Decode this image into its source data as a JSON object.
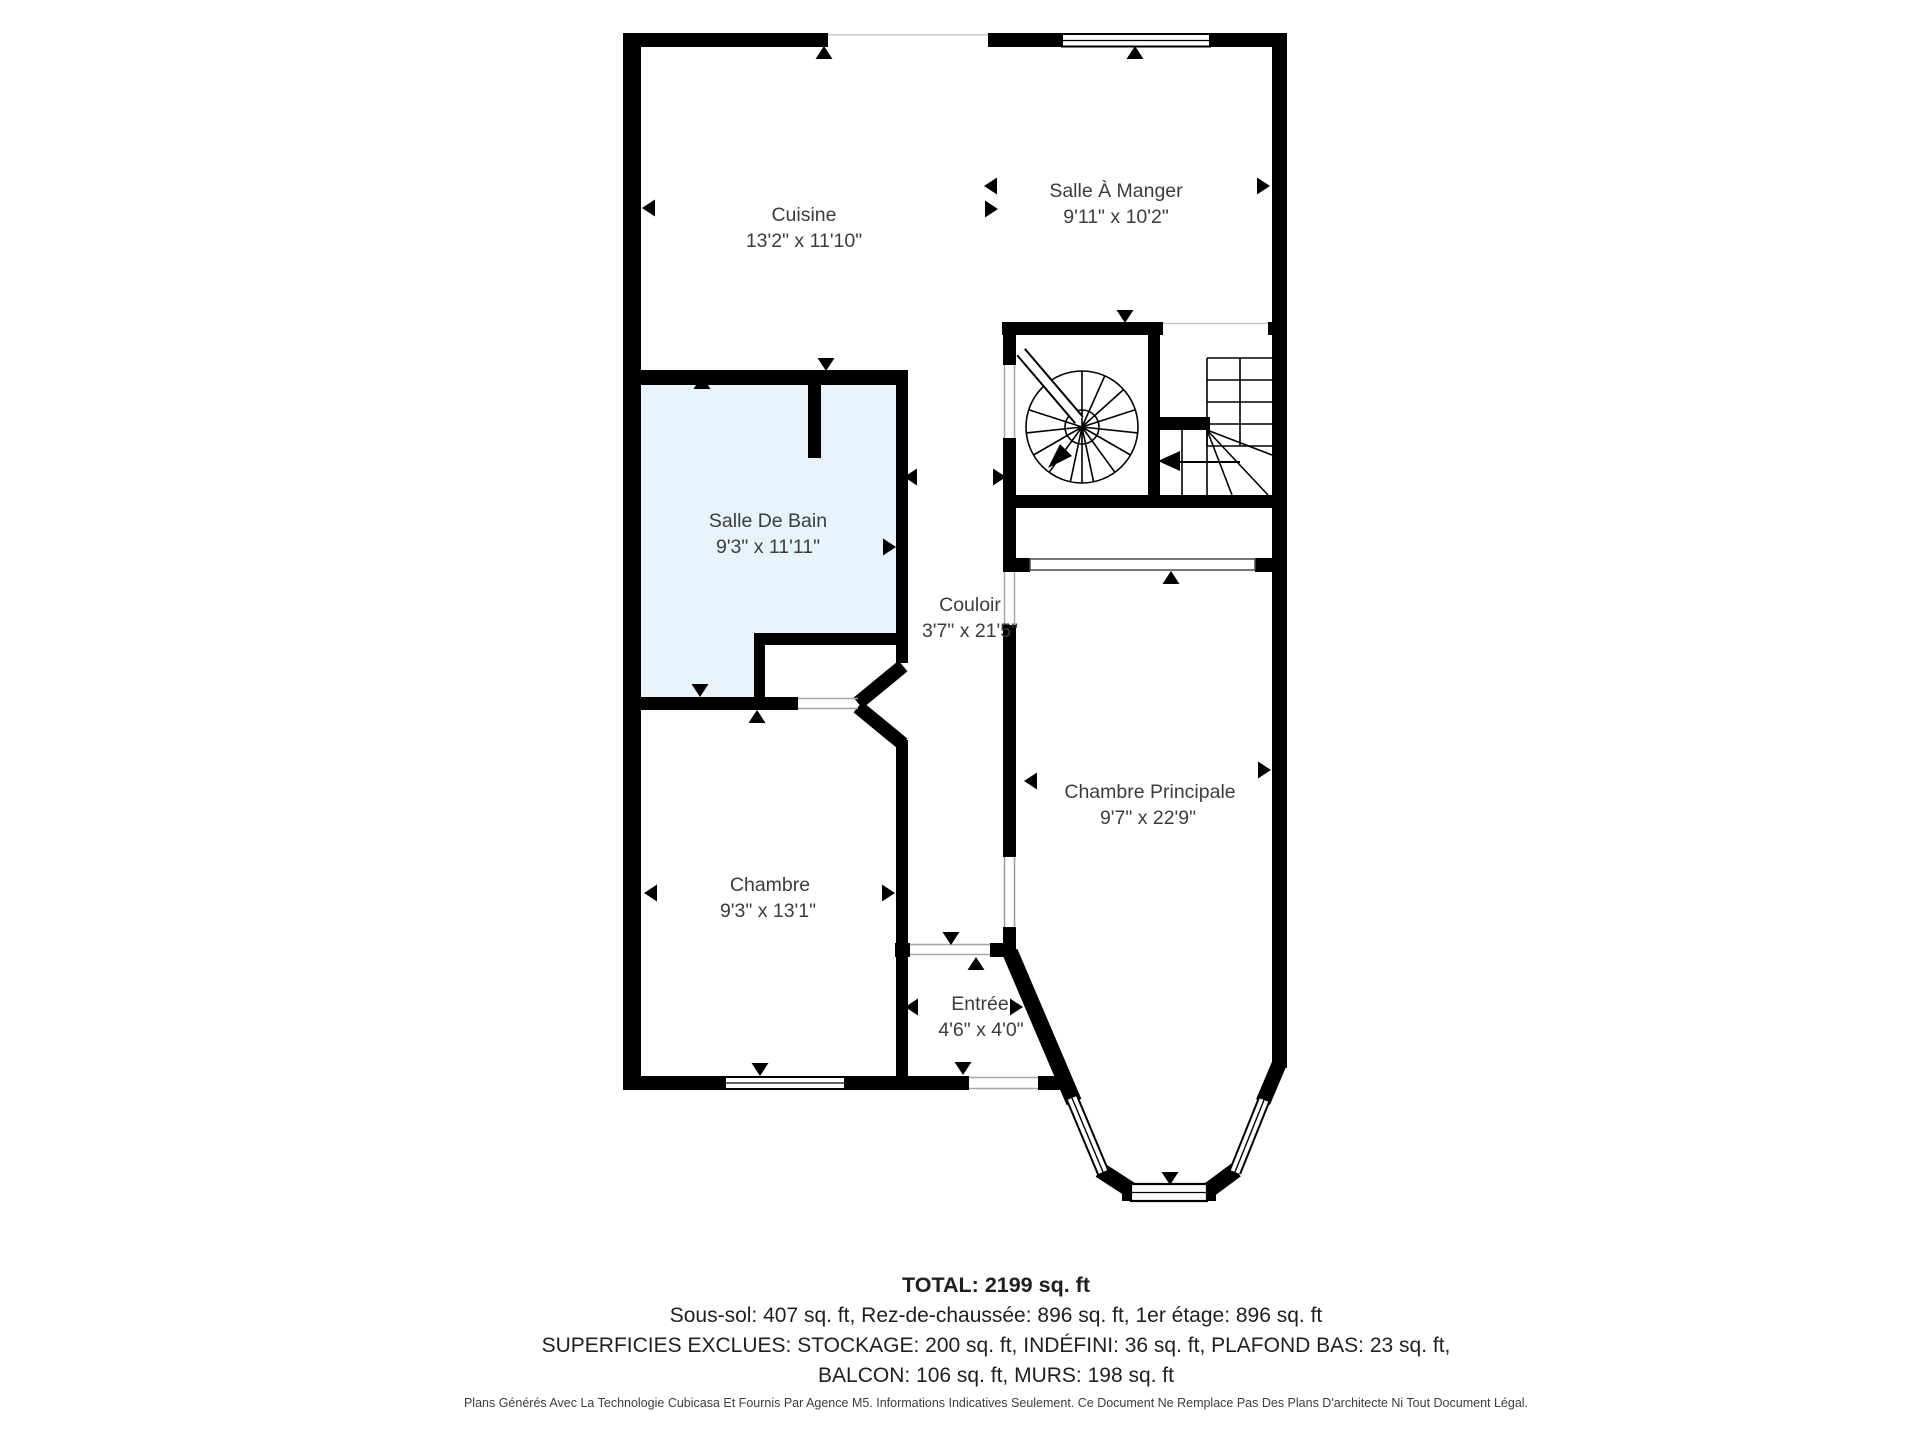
{
  "colors": {
    "wall": "#000000",
    "bathroom_fill": "#e8f2fb",
    "label_text": "#3c3c3c",
    "opening_line": "#a6a6a6"
  },
  "floor_plan": {
    "rooms": [
      {
        "id": "cuisine",
        "name": "Cuisine",
        "dims": "13'2\" x 11'10\""
      },
      {
        "id": "salle-a-manger",
        "name": "Salle À Manger",
        "dims": "9'11\" x 10'2\""
      },
      {
        "id": "salle-de-bain",
        "name": "Salle De Bain",
        "dims": "9'3\" x 11'11\""
      },
      {
        "id": "couloir",
        "name": "Couloir",
        "dims": "3'7\" x 21'5\""
      },
      {
        "id": "chambre",
        "name": "Chambre",
        "dims": "9'3\" x 13'1\""
      },
      {
        "id": "chambre-principale",
        "name": "Chambre Principale",
        "dims": "9'7\" x 22'9\""
      },
      {
        "id": "entree",
        "name": "Entrée",
        "dims": "4'6\" x 4'0\""
      }
    ]
  },
  "summary": {
    "total": "TOTAL: 2199 sq. ft",
    "floors": "Sous-sol: 407 sq. ft, Rez-de-chaussée: 896 sq. ft, 1er étage: 896 sq. ft",
    "excluded_line1": "SUPERFICIES EXCLUES: STOCKAGE: 200 sq. ft, INDÉFINI: 36 sq. ft, PLAFOND BAS: 23 sq. ft,",
    "excluded_line2": "BALCON: 106 sq. ft, MURS: 198 sq. ft"
  },
  "footer": {
    "disclaimer": "Plans Générés Avec La Technologie Cubicasa Et Fournis Par Agence M5. Informations Indicatives Seulement. Ce Document Ne Remplace Pas Des Plans D'architecte Ni Tout Document Légal."
  }
}
